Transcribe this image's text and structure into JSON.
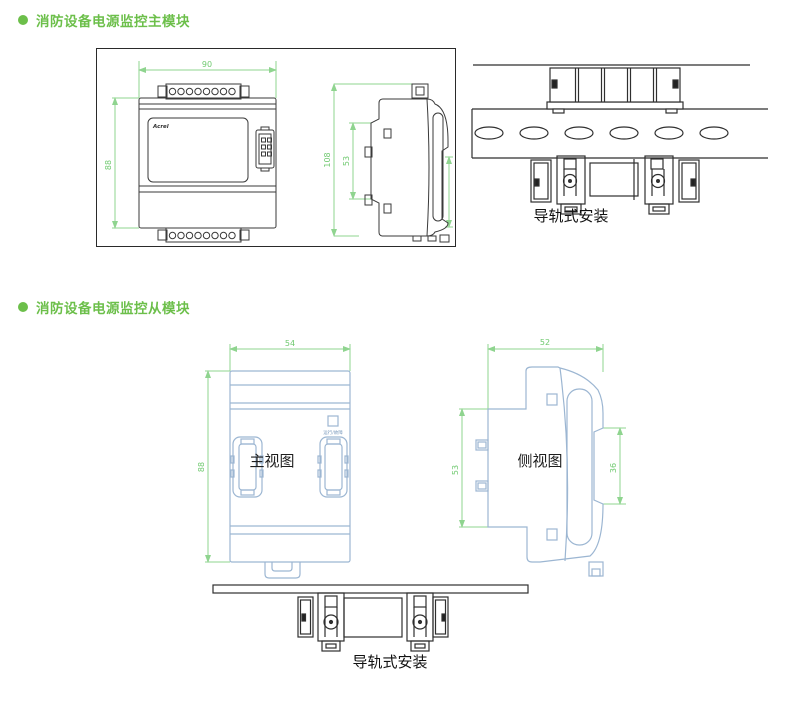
{
  "section1": {
    "heading": "消防设备电源监控主模块",
    "front_view": {
      "logo": "Acrel",
      "width_mm": "90",
      "height_mm": "88"
    },
    "side_view": {
      "height_mm": "108",
      "body_height_mm": "53"
    },
    "rail_caption": "导轨式安装"
  },
  "section2": {
    "heading": "消防设备电源监控从模块",
    "front_view": {
      "label": "主视图",
      "width_mm": "54",
      "height_mm": "88",
      "indicator_label": "运行/故障"
    },
    "side_view": {
      "label": "侧视图",
      "width_mm": "52",
      "body_height_mm": "53",
      "rail_slot_mm": "36"
    },
    "rail_caption": "导轨式安装"
  },
  "colors": {
    "accent_green": "#6cbf4a",
    "dimension_green": "#8fd48f",
    "drawing_black": "#3a3a3a",
    "drawing_blue": "#9cb6d2"
  }
}
